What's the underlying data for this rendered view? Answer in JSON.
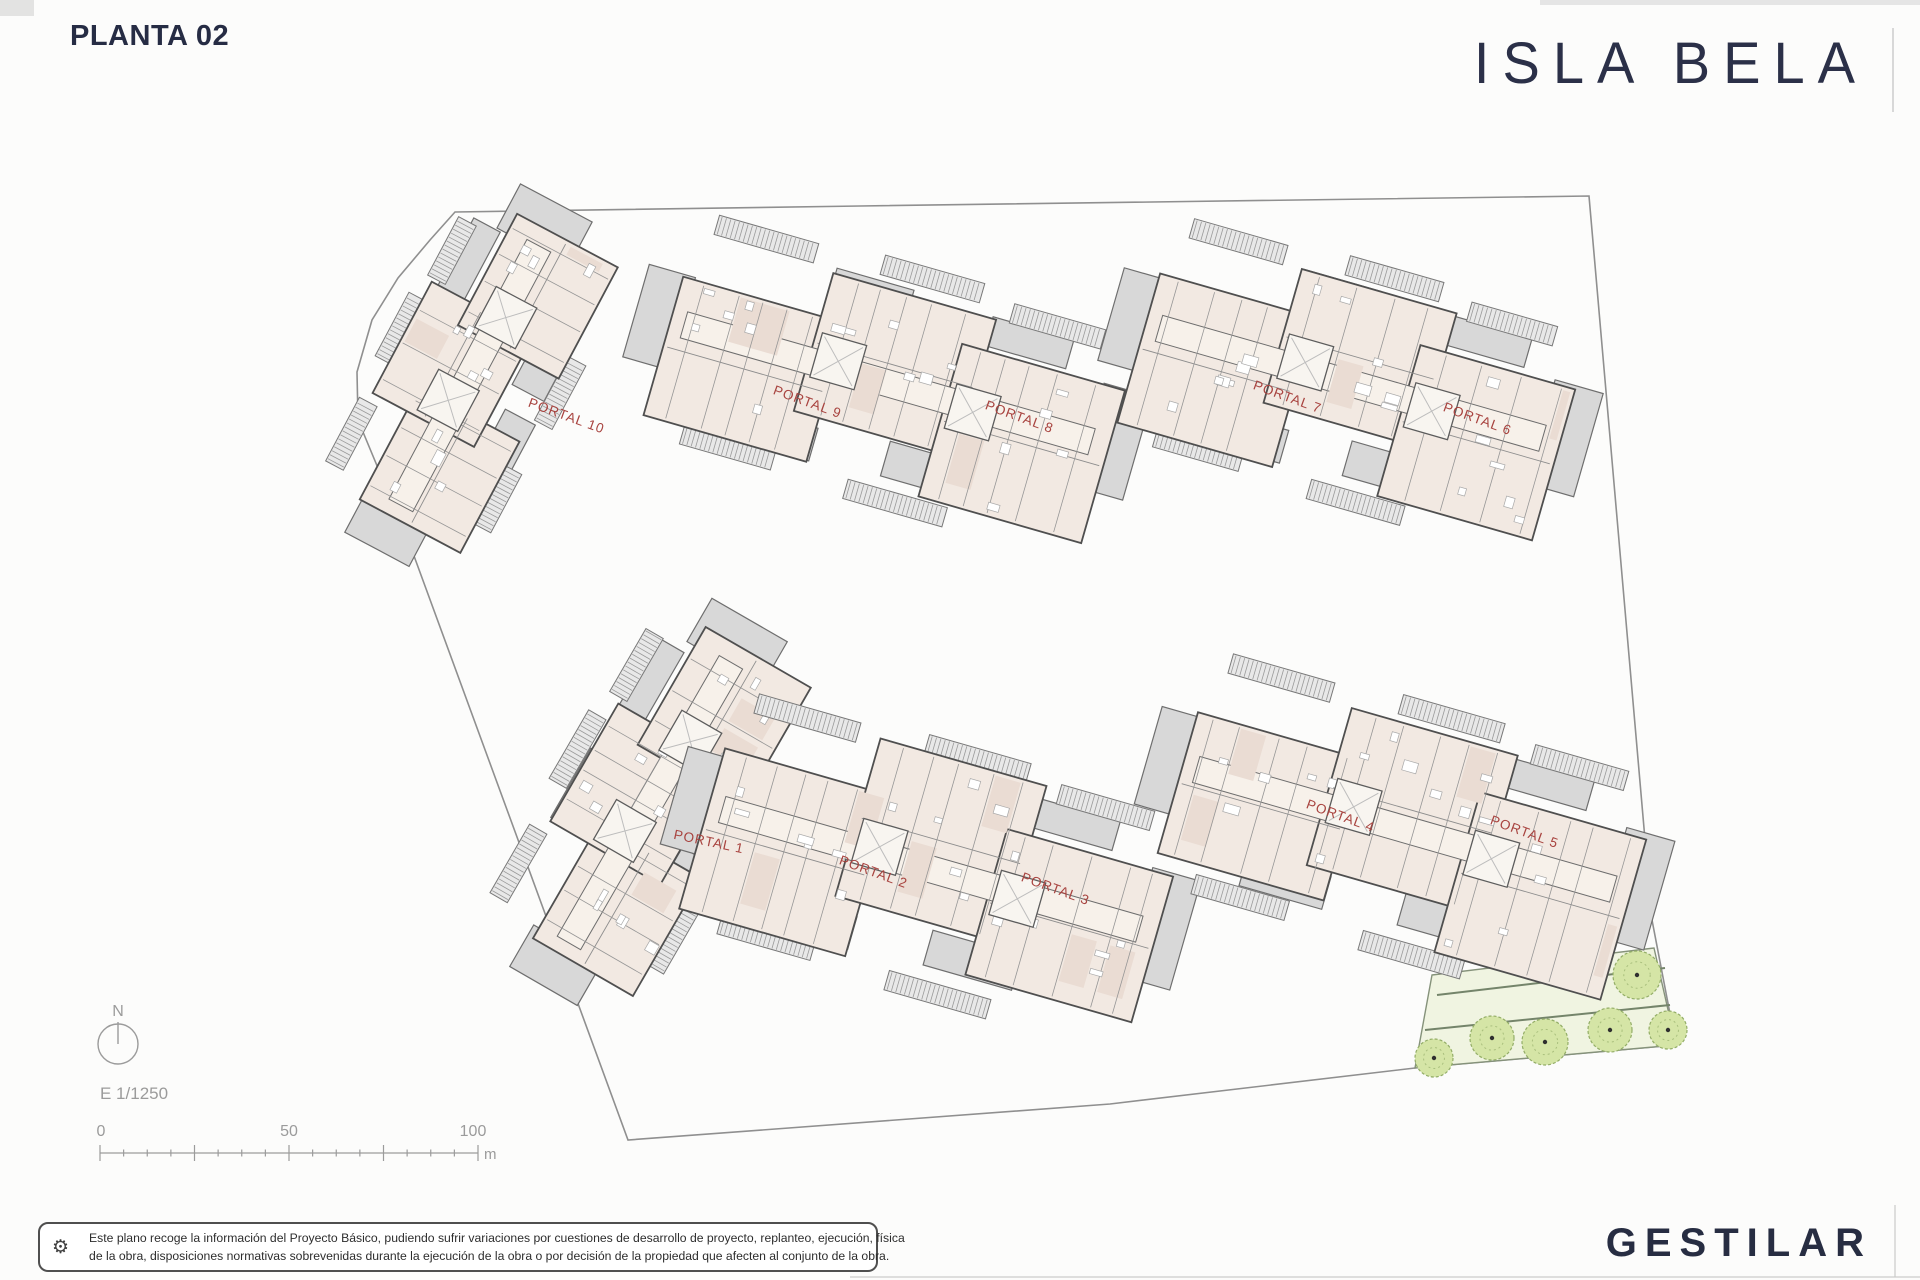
{
  "page": {
    "title": "PLANTA 02",
    "brand_logo": "ISLA BELA",
    "developer_logo": "GESTILAR"
  },
  "disclaimer": {
    "icon": "gear",
    "line1": "Este plano recoge la información del Proyecto Básico, pudiendo sufrir variaciones por cuestiones de desarrollo de proyecto, replanteo, ejecución, física",
    "line2": "de la obra, disposiciones normativas sobrevenidas durante la ejecución de la obra o por decisión de la propiedad que afecten al conjunto de la obra."
  },
  "map_legend": {
    "north": "N",
    "scale": "E 1/1250",
    "tick_labels": [
      "0",
      "50",
      "100"
    ],
    "unit": "m"
  },
  "site_plan": {
    "portal_label_color": "#a8433f",
    "portals": [
      {
        "label": "PORTAL 10",
        "x": 565,
        "y": 420,
        "rot": 20
      },
      {
        "label": "PORTAL 9",
        "x": 806,
        "y": 406,
        "rot": 20
      },
      {
        "label": "PORTAL 8",
        "x": 1018,
        "y": 421,
        "rot": 20
      },
      {
        "label": "PORTAL 7",
        "x": 1286,
        "y": 401,
        "rot": 20
      },
      {
        "label": "PORTAL 6",
        "x": 1476,
        "y": 423,
        "rot": 20
      },
      {
        "label": "PORTAL 1",
        "x": 708,
        "y": 846,
        "rot": 12
      },
      {
        "label": "PORTAL 2",
        "x": 872,
        "y": 876,
        "rot": 20
      },
      {
        "label": "PORTAL 3",
        "x": 1054,
        "y": 893,
        "rot": 20
      },
      {
        "label": "PORTAL 4",
        "x": 1339,
        "y": 820,
        "rot": 20
      },
      {
        "label": "PORTAL 5",
        "x": 1523,
        "y": 836,
        "rot": 20
      }
    ],
    "boundary": [
      [
        455,
        212
      ],
      [
        860,
        206
      ],
      [
        1589,
        196
      ],
      [
        1652,
        920
      ],
      [
        1676,
        1045
      ],
      [
        1415,
        1068
      ],
      [
        1110,
        1104
      ],
      [
        628,
        1140
      ],
      [
        410,
        545
      ],
      [
        358,
        420
      ],
      [
        357,
        372
      ],
      [
        372,
        320
      ],
      [
        398,
        278
      ],
      [
        430,
        240
      ]
    ],
    "buildings": [
      {
        "id": "portal-10",
        "cx": 468,
        "cy": 378,
        "rot": -62,
        "len": 300,
        "depth": 140,
        "wings": 3,
        "seed": 11
      },
      {
        "id": "portales-9-8",
        "cx": 885,
        "cy": 382,
        "rot": 16,
        "len": 430,
        "depth": 185,
        "wings": 3,
        "seed": 22
      },
      {
        "id": "portales-7-6",
        "cx": 1348,
        "cy": 382,
        "rot": 16,
        "len": 405,
        "depth": 185,
        "wings": 3,
        "seed": 33
      },
      {
        "id": "portal-1",
        "cx": 648,
        "cy": 805,
        "rot": -60,
        "len": 330,
        "depth": 150,
        "wings": 3,
        "seed": 44
      },
      {
        "id": "portales-2-3",
        "cx": 928,
        "cy": 868,
        "rot": 16,
        "len": 440,
        "depth": 195,
        "wings": 3,
        "seed": 55
      },
      {
        "id": "portales-4-5",
        "cx": 1402,
        "cy": 828,
        "rot": 16,
        "len": 440,
        "depth": 195,
        "wings": 3,
        "seed": 66
      }
    ],
    "green_area": {
      "outline": [
        [
          1432,
          975
        ],
        [
          1654,
          948
        ],
        [
          1676,
          1045
        ],
        [
          1415,
          1068
        ]
      ],
      "paths": [
        [
          [
            1437,
            995
          ],
          [
            1665,
            968
          ]
        ],
        [
          [
            1425,
            1030
          ],
          [
            1670,
            1005
          ]
        ]
      ],
      "trees": [
        {
          "x": 1637,
          "y": 975,
          "r": 24
        },
        {
          "x": 1434,
          "y": 1058,
          "r": 19
        },
        {
          "x": 1492,
          "y": 1038,
          "r": 22
        },
        {
          "x": 1545,
          "y": 1042,
          "r": 23
        },
        {
          "x": 1610,
          "y": 1030,
          "r": 22
        },
        {
          "x": 1668,
          "y": 1030,
          "r": 19
        }
      ]
    }
  }
}
